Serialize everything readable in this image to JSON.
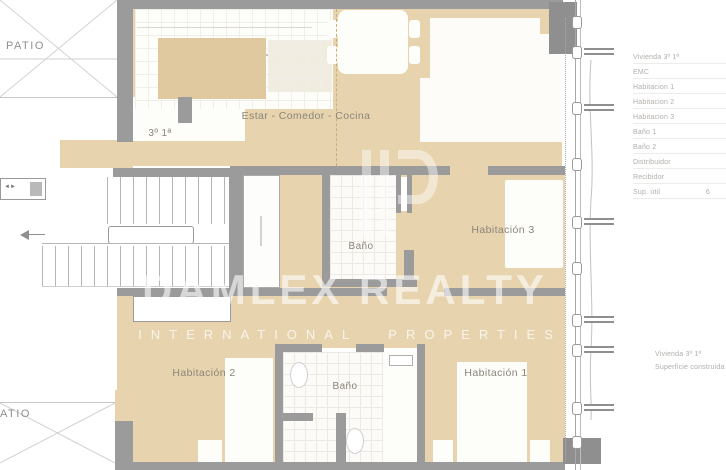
{
  "plan": {
    "rooms": {
      "living": "Estar - Comedor - Cocina",
      "bath_main": "Baño",
      "bath_bottom": "Baño",
      "bedroom1": "Habitación 1",
      "bedroom2": "Habitación 2",
      "bedroom3": "Habitación 3",
      "unit": "3º 1ª",
      "patio_top": "PATIO",
      "patio_bottom": "PATIO"
    }
  },
  "watermark": {
    "brand": "DAMLEX REALTY",
    "tagline": "INTERNATIONAL PROPERTIES"
  },
  "legend": {
    "rows": [
      {
        "label": "Vivienda 3º 1ª",
        "value": ""
      },
      {
        "label": "EMC",
        "value": ""
      },
      {
        "label": "Habitacion 1",
        "value": ""
      },
      {
        "label": "Habitacion 2",
        "value": ""
      },
      {
        "label": "Habitacion 3",
        "value": ""
      },
      {
        "label": "Baño 1",
        "value": ""
      },
      {
        "label": "Baño 2",
        "value": ""
      },
      {
        "label": "Distribuidor",
        "value": ""
      },
      {
        "label": "Recibidor",
        "value": ""
      },
      {
        "label": "Sup. útil",
        "value": "6"
      }
    ]
  },
  "footnote": {
    "line1": "Vivienda 3º 1ª",
    "line2": "Superficie construida"
  },
  "colors": {
    "floor_tan": "#e7d4ae",
    "floor_tan_dark": "#e0c99e",
    "wall_gray": "#9b9b9b",
    "label_gray": "#8b8579",
    "legend_gray": "#b2aeaa",
    "watermark_white": "rgba(255,255,255,0.6)"
  }
}
